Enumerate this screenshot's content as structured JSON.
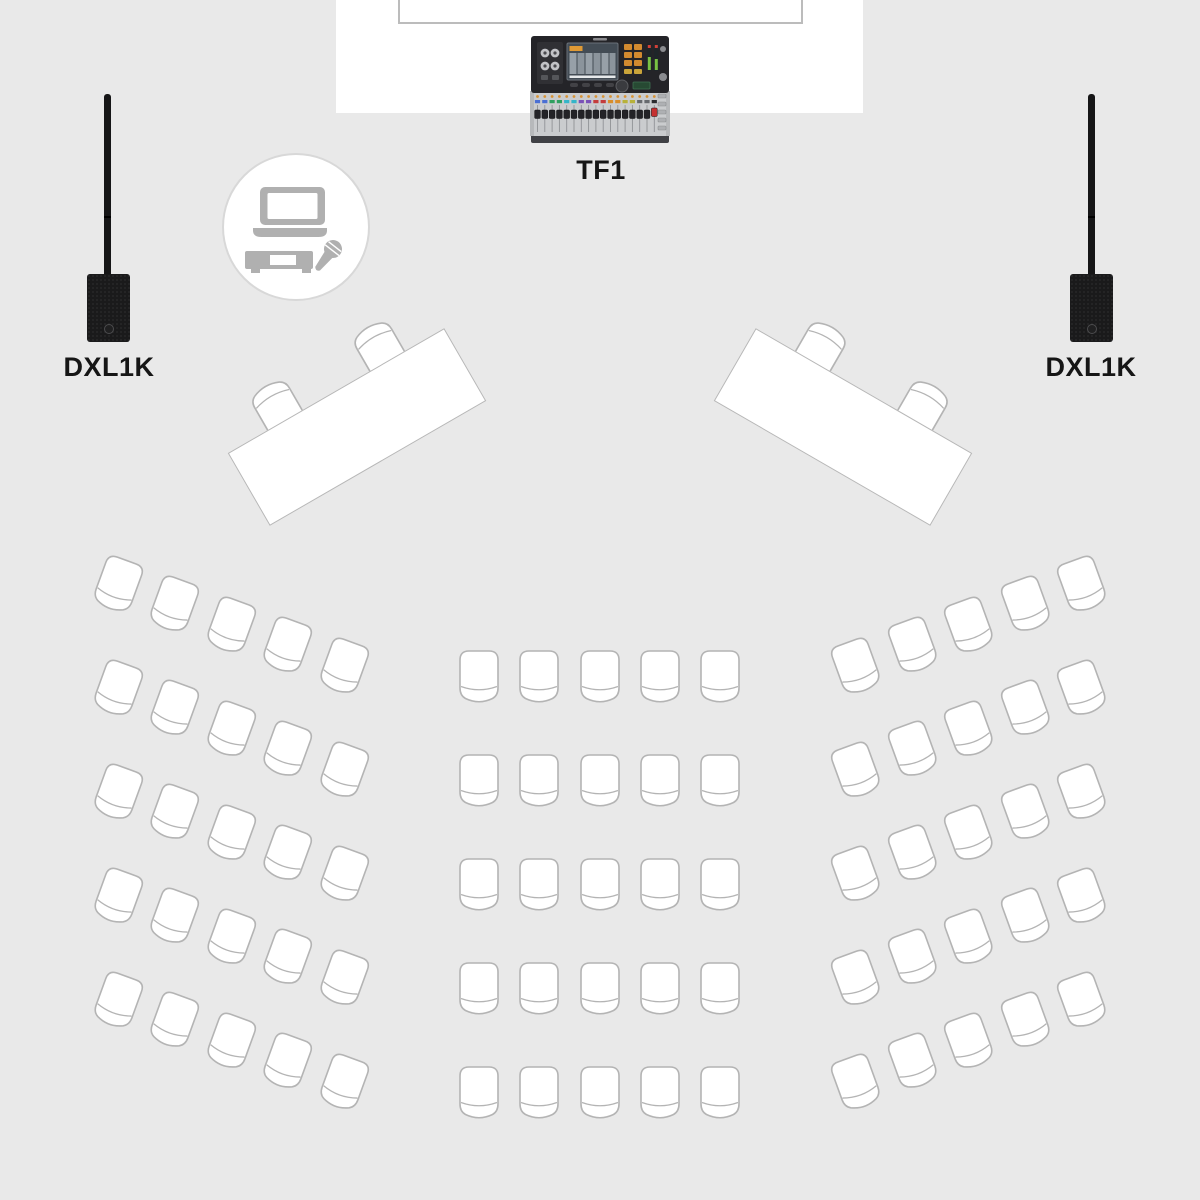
{
  "labels": {
    "mixer": "TF1",
    "left_speaker": "DXL1K",
    "right_speaker": "DXL1K"
  },
  "colors": {
    "background": "#e9e9e9",
    "surface_white": "#ffffff",
    "outline_gray": "#b4b4b4",
    "badge_border": "#d8d8d8",
    "icon_gray": "#b0b0b0",
    "speaker_black": "#1a1a1b",
    "label_text": "#161616"
  },
  "av_sources": {
    "icons": [
      "laptop-icon",
      "media-player-icon",
      "microphone-icon"
    ]
  },
  "mixer_image": {
    "description": "yamaha-tf1-digital-mixer",
    "select_button_color": "#d89233",
    "master_fader_color": "#c53030",
    "channel_colors": [
      "#4a6fd4",
      "#4a6fd4",
      "#2ea05f",
      "#2ea05f",
      "#34b5c9",
      "#34b5c9",
      "#7a52b8",
      "#7a52b8",
      "#c43c3c",
      "#c43c3c",
      "#d98e2b",
      "#d98e2b",
      "#b8b23a",
      "#b8b23a",
      "#666a6e",
      "#666a6e",
      "#2b2b2e"
    ]
  },
  "tables": {
    "count": 2,
    "chairs_per_table": 2,
    "angles_deg": [
      -30,
      30
    ]
  },
  "seating": {
    "total_chairs": 75,
    "sections": [
      {
        "name": "left",
        "rows": 5,
        "cols": 5,
        "start": {
          "x": 118,
          "y": 584
        },
        "col_step": {
          "x": 56.4,
          "y": 20.5
        },
        "row_step": {
          "x": 0,
          "y": 104
        },
        "chair_angle": 20
      },
      {
        "name": "center",
        "rows": 5,
        "cols": 5,
        "start": {
          "x": 479,
          "y": 676
        },
        "col_step": {
          "x": 60.3,
          "y": 0
        },
        "row_step": {
          "x": 0,
          "y": 104
        },
        "chair_angle": 0
      },
      {
        "name": "right",
        "rows": 5,
        "cols": 5,
        "start": {
          "x": 1082,
          "y": 584
        },
        "col_step": {
          "x": -56.4,
          "y": 20.5
        },
        "row_step": {
          "x": 0,
          "y": 104
        },
        "chair_angle": -20
      }
    ]
  }
}
